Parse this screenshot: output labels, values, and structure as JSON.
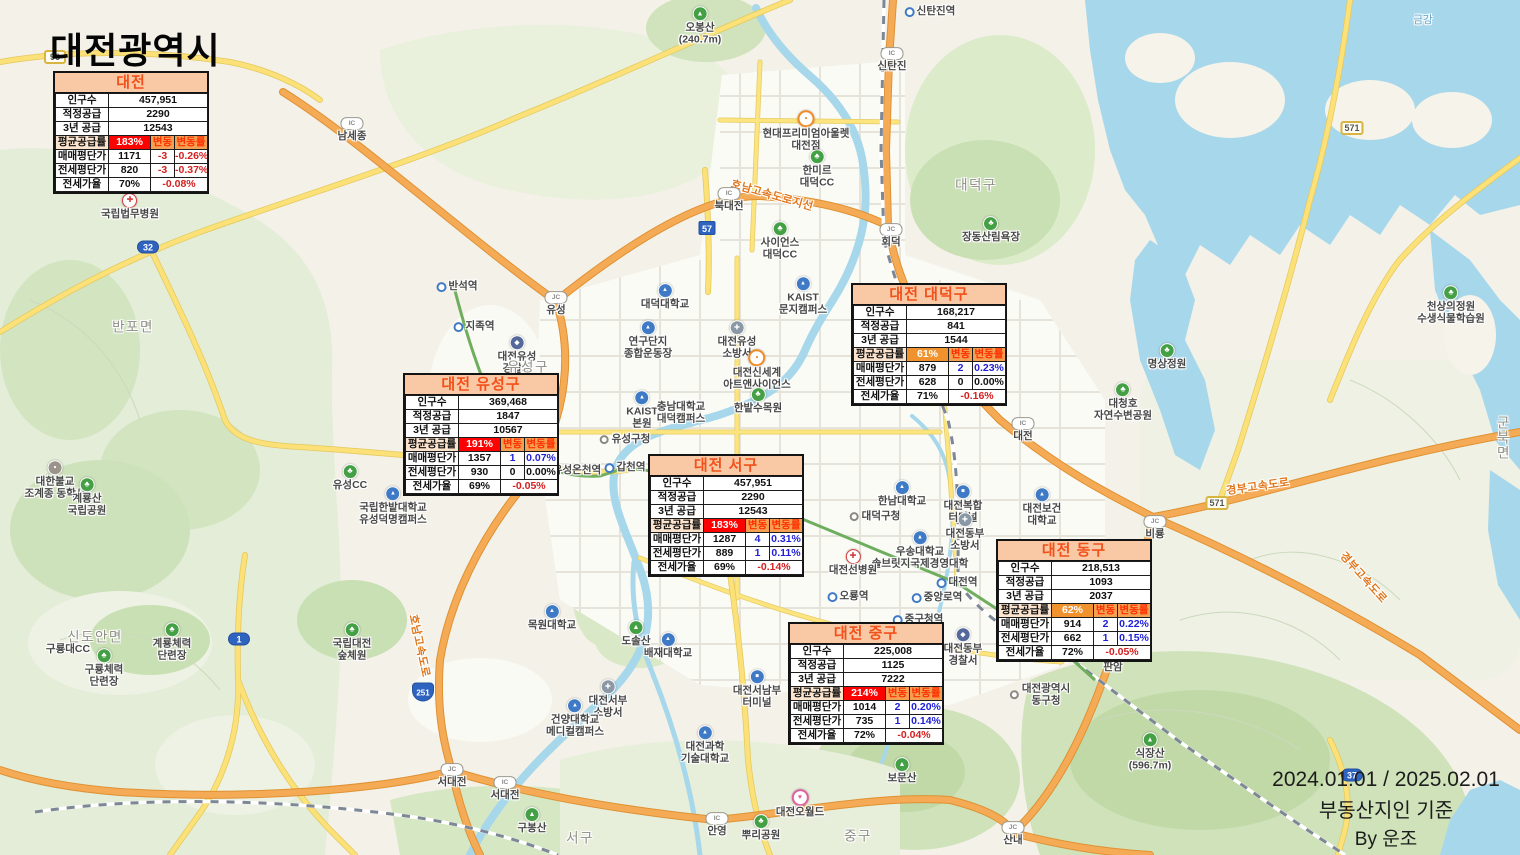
{
  "title": "대전광역시",
  "footer": {
    "line1": "2024.01.01 / 2025.02.01",
    "line2": "부동산지인 기준",
    "line3": "By 운조"
  },
  "colors": {
    "title_text": "#f2511b",
    "title_bg": "#f8c9a4",
    "supply_high_bg": "#fe0101",
    "supply_mid_bg": "#f0922e",
    "change_header_bg": "#f4a053",
    "change_header_text": "#ff2f00",
    "positive": "#1f1fd8",
    "negative": "#d42020"
  },
  "table_labels": {
    "population": "인구수",
    "proper_supply": "적정공급",
    "three_year_supply": "3년 공급",
    "avg_supply_rate": "평균공급률",
    "sale_price": "매매평단가",
    "jeonse_price": "전세평단가",
    "jeonse_ratio": "전세가율",
    "change": "변동",
    "change_rate": "변동률"
  },
  "tables": [
    {
      "id": "daejeon",
      "title": "대전",
      "population": "457,951",
      "proper_supply": "2290",
      "three_year_supply": "12543",
      "supply_rate": "183%",
      "supply_level": "high",
      "sale": {
        "price": "1171",
        "change": "-3",
        "rate": "-0.26%"
      },
      "jeonse": {
        "price": "820",
        "change": "-3",
        "rate": "-0.37%"
      },
      "ratio": "70%",
      "ratio_rate": "-0.08%"
    },
    {
      "id": "yuseong",
      "title": "대전 유성구",
      "population": "369,468",
      "proper_supply": "1847",
      "three_year_supply": "10567",
      "supply_rate": "191%",
      "supply_level": "high",
      "sale": {
        "price": "1357",
        "change": "1",
        "rate": "0.07%"
      },
      "jeonse": {
        "price": "930",
        "change": "0",
        "rate": "0.00%"
      },
      "ratio": "69%",
      "ratio_rate": "-0.05%"
    },
    {
      "id": "seogu",
      "title": "대전 서구",
      "population": "457,951",
      "proper_supply": "2290",
      "three_year_supply": "12543",
      "supply_rate": "183%",
      "supply_level": "high",
      "sale": {
        "price": "1287",
        "change": "4",
        "rate": "0.31%"
      },
      "jeonse": {
        "price": "889",
        "change": "1",
        "rate": "0.11%"
      },
      "ratio": "69%",
      "ratio_rate": "-0.14%"
    },
    {
      "id": "daedeok",
      "title": "대전 대덕구",
      "population": "168,217",
      "proper_supply": "841",
      "three_year_supply": "1544",
      "supply_rate": "61%",
      "supply_level": "mid",
      "sale": {
        "price": "879",
        "change": "2",
        "rate": "0.23%"
      },
      "jeonse": {
        "price": "628",
        "change": "0",
        "rate": "0.00%"
      },
      "ratio": "71%",
      "ratio_rate": "-0.16%"
    },
    {
      "id": "donggu",
      "title": "대전 동구",
      "population": "218,513",
      "proper_supply": "1093",
      "three_year_supply": "2037",
      "supply_rate": "62%",
      "supply_level": "mid",
      "sale": {
        "price": "914",
        "change": "2",
        "rate": "0.22%"
      },
      "jeonse": {
        "price": "662",
        "change": "1",
        "rate": "0.15%"
      },
      "ratio": "72%",
      "ratio_rate": "-0.05%"
    },
    {
      "id": "junggu",
      "title": "대전 중구",
      "population": "225,008",
      "proper_supply": "1125",
      "three_year_supply": "7222",
      "supply_rate": "214%",
      "supply_level": "high",
      "sale": {
        "price": "1014",
        "change": "2",
        "rate": "0.20%"
      },
      "jeonse": {
        "price": "735",
        "change": "1",
        "rate": "0.14%"
      },
      "ratio": "72%",
      "ratio_rate": "-0.04%"
    }
  ],
  "map": {
    "labels": [
      {
        "t": "국립법무병원",
        "x": 130,
        "y": 207,
        "ty": "hospital"
      },
      {
        "t": "반포면",
        "x": 133,
        "y": 327,
        "ty": "district"
      },
      {
        "t": "대한불교\n조계종 동학사",
        "x": 55,
        "y": 480,
        "ty": "temple"
      },
      {
        "t": "계룡산\n국립공원",
        "x": 87,
        "y": 497,
        "ty": "park"
      },
      {
        "t": "유성CC",
        "x": 350,
        "y": 478,
        "ty": "park"
      },
      {
        "t": "국립한밭대학교\n유성덕명캠퍼스",
        "x": 393,
        "y": 506,
        "ty": "univ"
      },
      {
        "t": "신도안면",
        "x": 95,
        "y": 637,
        "ty": "district"
      },
      {
        "t": "구룡대CC",
        "x": 68,
        "y": 650,
        "ty": "plain"
      },
      {
        "t": "구룡체력\n단련장",
        "x": 104,
        "y": 668,
        "ty": "park"
      },
      {
        "t": "계룡체력\n단련장",
        "x": 172,
        "y": 642,
        "ty": "park"
      },
      {
        "t": "국립대전\n숲체원",
        "x": 352,
        "y": 642,
        "ty": "park"
      },
      {
        "t": "남세종",
        "x": 352,
        "y": 130,
        "ty": "ic"
      },
      {
        "t": "반석역",
        "x": 457,
        "y": 287,
        "ty": "station"
      },
      {
        "t": "지족역",
        "x": 474,
        "y": 327,
        "ty": "station"
      },
      {
        "t": "유성",
        "x": 556,
        "y": 304,
        "ty": "jc"
      },
      {
        "t": "대덕대학교",
        "x": 665,
        "y": 297,
        "ty": "univ"
      },
      {
        "t": "연구단지\n종합운동장",
        "x": 648,
        "y": 340,
        "ty": "univ"
      },
      {
        "t": "KAIST\n본원",
        "x": 642,
        "y": 410,
        "ty": "univ"
      },
      {
        "t": "충남대학교\n대덕캠퍼스",
        "x": 681,
        "y": 413,
        "ty": "plain"
      },
      {
        "t": "유성구청",
        "x": 625,
        "y": 440,
        "ty": "govt"
      },
      {
        "t": "유성온천역",
        "x": 571,
        "y": 471,
        "ty": "station"
      },
      {
        "t": "갑천역",
        "x": 625,
        "y": 468,
        "ty": "station"
      },
      {
        "t": "대전유성\n경찰서",
        "x": 517,
        "y": 355,
        "ty": "police"
      },
      {
        "t": "유성구",
        "x": 528,
        "y": 367,
        "ty": "district"
      },
      {
        "t": "대전유성\n소방서",
        "x": 737,
        "y": 340,
        "ty": "fire"
      },
      {
        "t": "대전신세계\n아트앤사이언스",
        "x": 757,
        "y": 370,
        "ty": "shopping"
      },
      {
        "t": "한밭수목원",
        "x": 758,
        "y": 401,
        "ty": "park"
      },
      {
        "t": "KAIST\n문지캠퍼스",
        "x": 803,
        "y": 296,
        "ty": "univ"
      },
      {
        "t": "오봉산\n(240.7m)",
        "x": 700,
        "y": 26,
        "ty": "mountain"
      },
      {
        "t": "신탄진역",
        "x": 930,
        "y": 12,
        "ty": "station"
      },
      {
        "t": "신탄진",
        "x": 892,
        "y": 60,
        "ty": "ic"
      },
      {
        "t": "현대프리미엄아울렛\n대전점",
        "x": 806,
        "y": 131,
        "ty": "shopping"
      },
      {
        "t": "한미르\n대덕CC",
        "x": 817,
        "y": 169,
        "ty": "park"
      },
      {
        "t": "호남고속도로지선",
        "x": 772,
        "y": 196,
        "ty": "road",
        "rot": 16
      },
      {
        "t": "북대전",
        "x": 729,
        "y": 200,
        "ty": "ic"
      },
      {
        "t": "사이언스\n대덕CC",
        "x": 780,
        "y": 241,
        "ty": "park"
      },
      {
        "t": "회덕",
        "x": 891,
        "y": 236,
        "ty": "jc"
      },
      {
        "t": "장동산림욕장",
        "x": 991,
        "y": 230,
        "ty": "park"
      },
      {
        "t": "대덕구",
        "x": 976,
        "y": 185,
        "ty": "district"
      },
      {
        "t": "금강",
        "x": 1423,
        "y": 21,
        "ty": "water"
      },
      {
        "t": "명상정원",
        "x": 1167,
        "y": 357,
        "ty": "park"
      },
      {
        "t": "대청호\n자연수변공원",
        "x": 1123,
        "y": 402,
        "ty": "park"
      },
      {
        "t": "천상의정원\n수생식물학습원",
        "x": 1451,
        "y": 305,
        "ty": "park"
      },
      {
        "t": "군북면",
        "x": 1504,
        "y": 438,
        "ty": "district"
      },
      {
        "t": "경부고속도로",
        "x": 1258,
        "y": 487,
        "ty": "road",
        "rot": -8
      },
      {
        "t": "경부고속도로",
        "x": 1363,
        "y": 578,
        "ty": "road",
        "rot": 48
      },
      {
        "t": "호남고속도로",
        "x": 419,
        "y": 646,
        "ty": "road",
        "rot": 78
      },
      {
        "t": "비룡",
        "x": 1155,
        "y": 528,
        "ty": "jc"
      },
      {
        "t": "대전",
        "x": 1023,
        "y": 430,
        "ty": "ic"
      },
      {
        "t": "한남대학교",
        "x": 902,
        "y": 494,
        "ty": "univ"
      },
      {
        "t": "대전복합\n터미널",
        "x": 963,
        "y": 504,
        "ty": "terminal"
      },
      {
        "t": "대덕구청",
        "x": 875,
        "y": 517,
        "ty": "govt"
      },
      {
        "t": "대전보건\n대학교",
        "x": 1042,
        "y": 507,
        "ty": "univ"
      },
      {
        "t": "대전동부\n소방서",
        "x": 965,
        "y": 532,
        "ty": "fire"
      },
      {
        "t": "우송대학교\n솔브릿지국제경영대학",
        "x": 920,
        "y": 550,
        "ty": "univ"
      },
      {
        "t": "대전선병원",
        "x": 853,
        "y": 563,
        "ty": "hospital"
      },
      {
        "t": "오룡역",
        "x": 848,
        "y": 597,
        "ty": "station"
      },
      {
        "t": "대전역",
        "x": 957,
        "y": 583,
        "ty": "station"
      },
      {
        "t": "중앙로역",
        "x": 937,
        "y": 598,
        "ty": "station"
      },
      {
        "t": "중구청역",
        "x": 918,
        "y": 620,
        "ty": "station"
      },
      {
        "t": "대전동부\n경찰서",
        "x": 963,
        "y": 647,
        "ty": "police"
      },
      {
        "t": "판암역",
        "x": 1068,
        "y": 654,
        "ty": "station"
      },
      {
        "t": "판암",
        "x": 1113,
        "y": 661,
        "ty": "ic"
      },
      {
        "t": "대전광역시\n동구청",
        "x": 1040,
        "y": 695,
        "ty": "govt"
      },
      {
        "t": "식장산\n(596.7m)",
        "x": 1150,
        "y": 752,
        "ty": "mountain"
      },
      {
        "t": "산내",
        "x": 1013,
        "y": 834,
        "ty": "jc"
      },
      {
        "t": "목원대학교",
        "x": 552,
        "y": 618,
        "ty": "univ"
      },
      {
        "t": "도솔산",
        "x": 636,
        "y": 634,
        "ty": "mountain"
      },
      {
        "t": "배재대학교",
        "x": 668,
        "y": 646,
        "ty": "univ"
      },
      {
        "t": "대전서남부\n터미널",
        "x": 757,
        "y": 689,
        "ty": "terminal"
      },
      {
        "t": "대전서부\n소방서",
        "x": 608,
        "y": 699,
        "ty": "fire"
      },
      {
        "t": "건양대학교\n메디컬캠퍼스",
        "x": 575,
        "y": 718,
        "ty": "univ"
      },
      {
        "t": "대전과학\n기술대학교",
        "x": 705,
        "y": 745,
        "ty": "univ"
      },
      {
        "t": "서대전",
        "x": 452,
        "y": 776,
        "ty": "jc"
      },
      {
        "t": "서대전",
        "x": 505,
        "y": 789,
        "ty": "ic"
      },
      {
        "t": "구봉산",
        "x": 532,
        "y": 821,
        "ty": "mountain"
      },
      {
        "t": "서구",
        "x": 580,
        "y": 838,
        "ty": "district"
      },
      {
        "t": "안영",
        "x": 717,
        "y": 825,
        "ty": "ic"
      },
      {
        "t": "뿌리공원",
        "x": 761,
        "y": 828,
        "ty": "park"
      },
      {
        "t": "대전오월드",
        "x": 800,
        "y": 804,
        "ty": "attraction"
      },
      {
        "t": "보문산",
        "x": 902,
        "y": 771,
        "ty": "mountain"
      },
      {
        "t": "중구",
        "x": 858,
        "y": 836,
        "ty": "district"
      }
    ],
    "shields": [
      {
        "text": "96",
        "style": "rect-yellow",
        "x": 55,
        "y": 57
      },
      {
        "text": "32",
        "style": "oval-blue",
        "x": 148,
        "y": 247
      },
      {
        "text": "57",
        "style": "rect-blue",
        "x": 707,
        "y": 228
      },
      {
        "text": "1",
        "style": "oval-blue",
        "x": 239,
        "y": 639
      },
      {
        "text": "251",
        "style": "shield-blue",
        "x": 423,
        "y": 692
      },
      {
        "text": "571",
        "style": "rect-yellow",
        "x": 1352,
        "y": 128
      },
      {
        "text": "571",
        "style": "rect-yellow",
        "x": 1217,
        "y": 503
      },
      {
        "text": "37",
        "style": "oval-blue",
        "x": 1352,
        "y": 775
      }
    ]
  }
}
